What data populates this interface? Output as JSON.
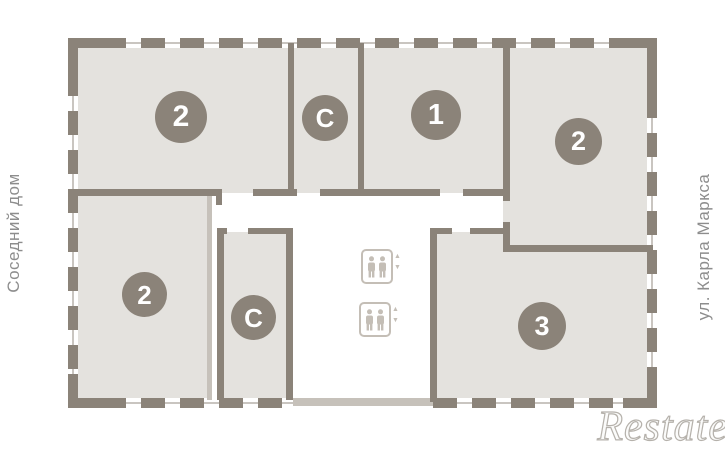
{
  "colors": {
    "wall_dark": "#8b8379",
    "wall_light": "#c6c1ba",
    "wall_thin": "#c9c5c0",
    "room_fill": "#e4e2de",
    "badge_fill": "#8b8379",
    "badge_text": "#ffffff",
    "side_label": "#8d8d8d",
    "elevator_icon": "#c4beb6",
    "watermark_stroke": "#b5b1ab"
  },
  "labels": {
    "left": "Соседний дом",
    "right": "ул. Карла Маркса"
  },
  "rooms": [
    {
      "name": "apartment-2-top-left",
      "label": "2"
    },
    {
      "name": "studio-top",
      "label": "С"
    },
    {
      "name": "apartment-1-top",
      "label": "1"
    },
    {
      "name": "apartment-2-right",
      "label": "2"
    },
    {
      "name": "apartment-2-bottom-left",
      "label": "2"
    },
    {
      "name": "studio-bottom",
      "label": "С"
    },
    {
      "name": "apartment-3-bottom-right",
      "label": "3"
    }
  ],
  "elevator": {
    "count": 2,
    "up_icon": "▲",
    "down_icon": "▼"
  },
  "watermark": {
    "text": "Restate"
  }
}
